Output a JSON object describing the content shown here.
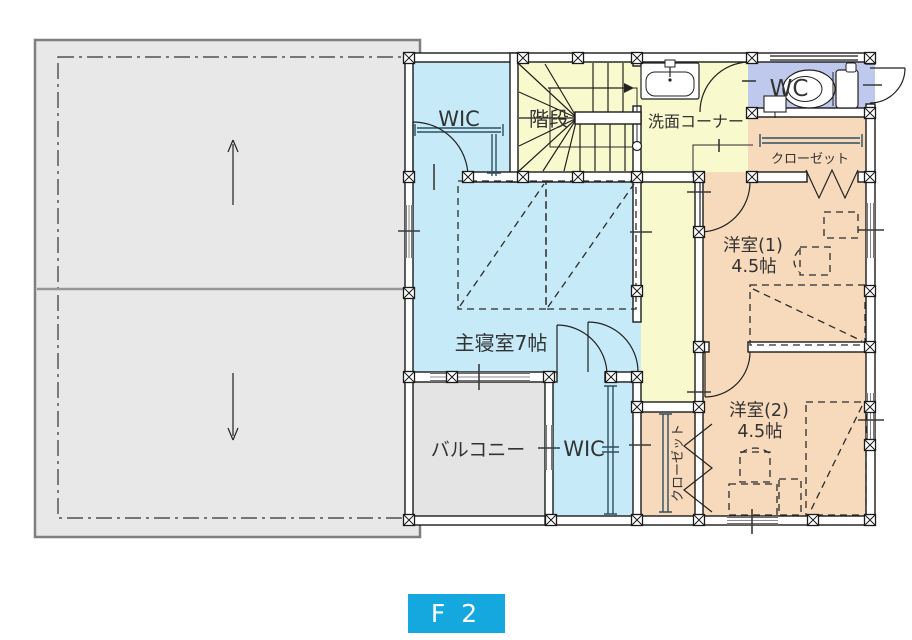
{
  "floor_label": "F 2",
  "colors": {
    "room_blue": "#c6eaf8",
    "room_yellow": "#f9f9ce",
    "room_orange": "#f7dabc",
    "room_purple": "#bfc9ee",
    "roof_gray": "#e8e8e8",
    "balcony_gray": "#e4e4e4",
    "badge_blue": "#14a8df",
    "badge_text": "#ffffff"
  },
  "rooms": {
    "wic_upper": {
      "label": "WIC"
    },
    "stairs": {
      "label": "階段"
    },
    "washroom": {
      "label": "洗面コーナー"
    },
    "wc": {
      "label": "WC"
    },
    "closet_upper": {
      "label": "クローゼット"
    },
    "western_room_1": {
      "label": "洋室(1)",
      "area": "4.5帖"
    },
    "western_room_2": {
      "label": "洋室(2)",
      "area": "4.5帖"
    },
    "master_bedroom": {
      "label": "主寝室7帖"
    },
    "balcony": {
      "label": "バルコニー"
    },
    "wic_lower": {
      "label": "WIC"
    },
    "closet_lower": {
      "label": "クローゼット"
    }
  }
}
